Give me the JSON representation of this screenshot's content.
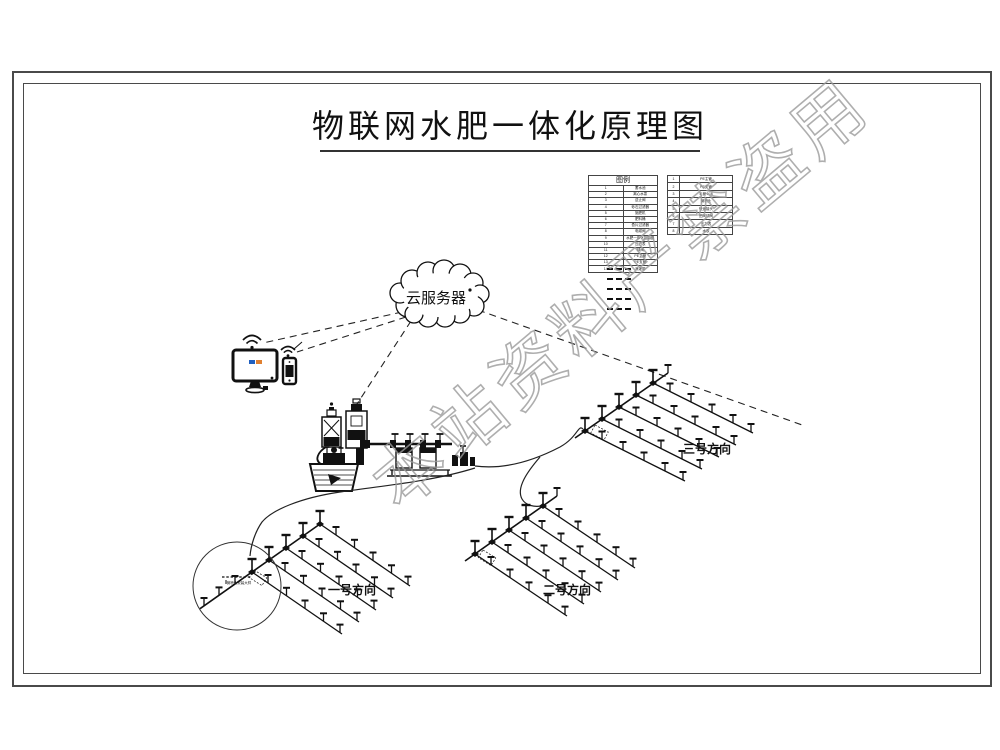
{
  "title": "物联网水肥一体化原理图",
  "watermark": "本站资料严禁盗用",
  "cloud": {
    "label": "云服务器"
  },
  "legend": {
    "header": "图例",
    "left_rows": [
      {
        "no": "1",
        "name": "蓄水池"
      },
      {
        "no": "2",
        "name": "离心水泵"
      },
      {
        "no": "3",
        "name": "逆止阀"
      },
      {
        "no": "4",
        "name": "砂石过滤器"
      },
      {
        "no": "5",
        "name": "施肥机"
      },
      {
        "no": "6",
        "name": "肥料桶"
      },
      {
        "no": "7",
        "name": "叠片过滤器"
      },
      {
        "no": "8",
        "name": "电磁阀"
      },
      {
        "no": "9",
        "name": "水肥一体化控制器"
      },
      {
        "no": "10",
        "name": "压力表"
      },
      {
        "no": "11",
        "name": "球阀"
      },
      {
        "no": "12",
        "name": "PE主管"
      },
      {
        "no": "13",
        "name": "PE支管"
      },
      {
        "no": "14",
        "name": "滴灌带"
      }
    ],
    "right_rows": [
      {
        "no": "1",
        "name": "PE主管"
      },
      {
        "no": "2",
        "name": "PE支管"
      },
      {
        "no": "3",
        "name": "毛管Φ16"
      },
      {
        "no": "4",
        "name": "微喷头"
      },
      {
        "no": "5",
        "name": "快速接头"
      },
      {
        "no": "6",
        "name": "田间球阀"
      },
      {
        "no": "7",
        "name": "压力表"
      },
      {
        "no": "8",
        "name": "水表"
      }
    ]
  },
  "fields": [
    {
      "label": "一号方向"
    },
    {
      "label": "二号方向"
    },
    {
      "label": "三号方向"
    }
  ],
  "callout": {
    "note": "微喷头安装大样"
  }
}
